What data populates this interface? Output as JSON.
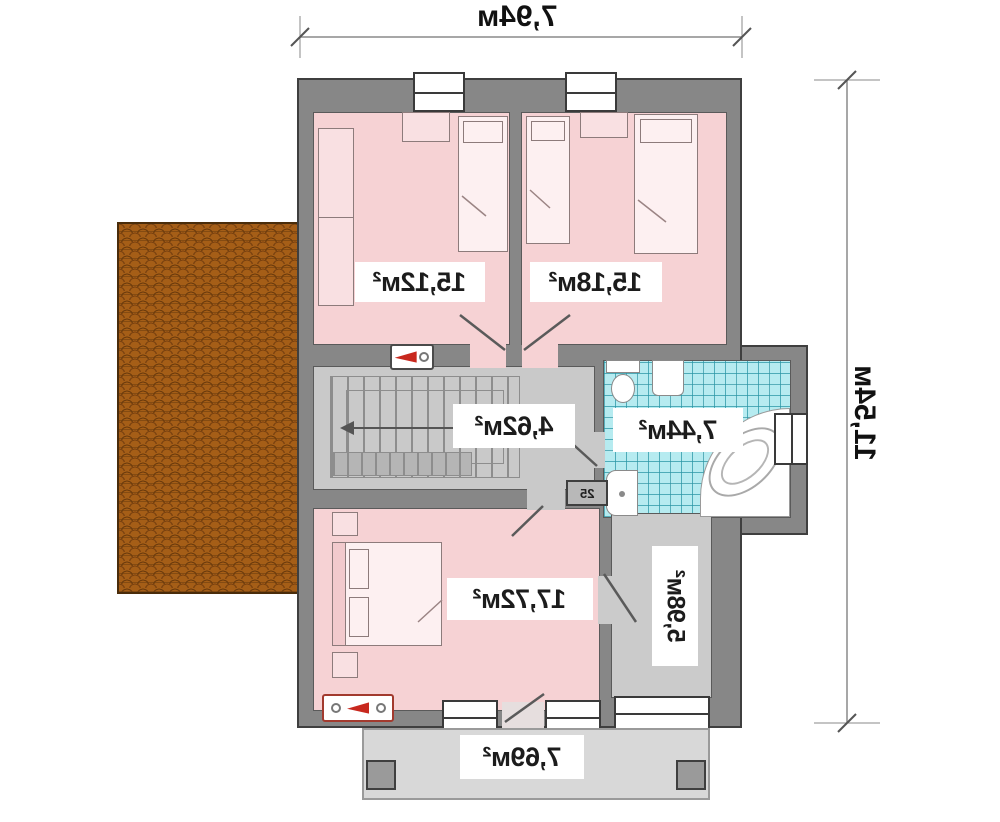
{
  "plan": {
    "dim_width": "7,94м",
    "dim_height": "11,54м",
    "rooms": {
      "bedroom_top_left": "15,12м²",
      "bedroom_top_right": "15,18м²",
      "stair_hall": "4,62м²",
      "bathroom": "7,44м²",
      "bedroom_bottom": "17,72м²",
      "dressing_room": "5,98м²",
      "balcony": "7,69м²"
    },
    "shaft_label": "25"
  },
  "colors": {
    "wall": "#878787",
    "room_pink": "#f6d2d4",
    "hall_gray": "#c9c9c9",
    "bathroom_tile": "#b6ebf0",
    "tile_grid": "#2a96a5",
    "roof_brick": "#a55e17",
    "balcony_gray": "#d8d8d8",
    "accent_red": "#c8281e",
    "line_dark": "#3f3f3f"
  }
}
